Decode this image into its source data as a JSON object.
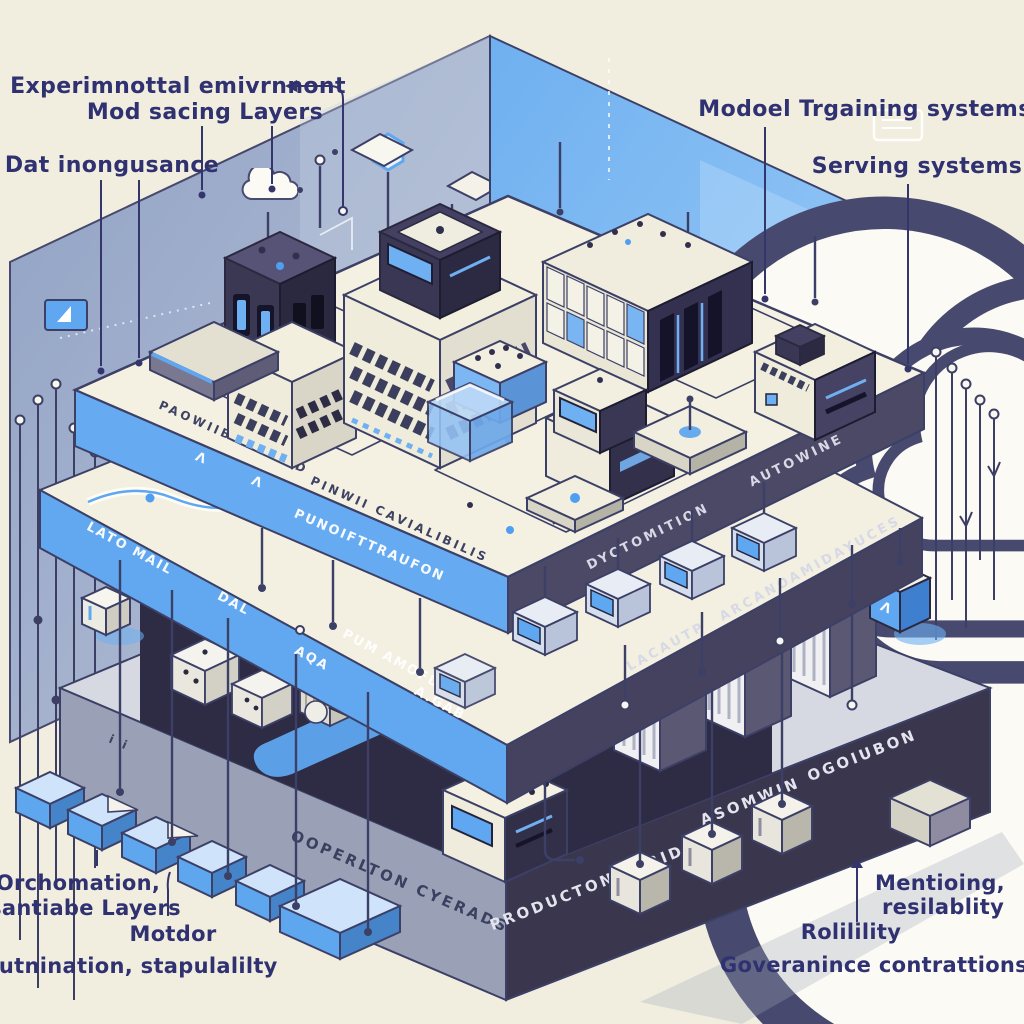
{
  "title": "Isometric ML infrastructure stack illustration",
  "colors": {
    "background": "#f1eee0",
    "wall_left": "#93a4c5",
    "wall_right": "#7cb6f2",
    "platform_cream": "#f4f1e2",
    "band_blue": "#61a8f0",
    "band_navy": "#494664",
    "block_gray": "#9aa1b7",
    "block_navy": "#39364e",
    "ink": "#3c3f63",
    "label_ink": "#2f3170",
    "accent_blue": "#4f9ef0"
  },
  "callouts": {
    "experimental": "Experimnottal emivrnnont",
    "mod_layers": "Mod sacing Layers",
    "data_ingestion": "Dat inongusance",
    "model_training": "Modoel Trgaining systems",
    "serving": "Serving systems",
    "orchestration_1": "Orchomation,",
    "orchestration_2": "santiabe Layers",
    "motdor": "Motdor",
    "automation": "Autnination, stapulalilty",
    "monitoring_1": "Mentioing,",
    "monitoring_2": "resilablity",
    "reliability": "Rolilility",
    "governance": "Goveranince contrattions"
  },
  "embossed": {
    "top_left_a": "PAOWIIBIBIBILAD",
    "top_left_b": "PINWII CAVIALIBILIS",
    "top_ticks_a": "MIJIIIIIIII",
    "top_ticks_b": "IIIIIIIIII",
    "band_front": "PUNOIFTTRAUFON",
    "band_right_a": "AUTOWINE",
    "band_right_b": "DYCTOMITION",
    "mid_left_a": "LATO MAIL",
    "mid_left_b": "DAL",
    "mid_left_c": "AQA",
    "mid_left_d": "PUM AMOFUNE",
    "mid_left_e": "A.GAB",
    "mid_right_a": "ARCANOAMIDAYUCES",
    "mid_right_b": "LACAUTP",
    "bottom_left": "OOPERLTON CYERADS",
    "bottom_right_a": "OGOIUBON",
    "bottom_right_b": "ASOMWIN",
    "bottom_right_c": "PRODUCTONWORIDE",
    "face_marks": "i i",
    "chevron": "Λ",
    "cube_mark": "Λ"
  }
}
